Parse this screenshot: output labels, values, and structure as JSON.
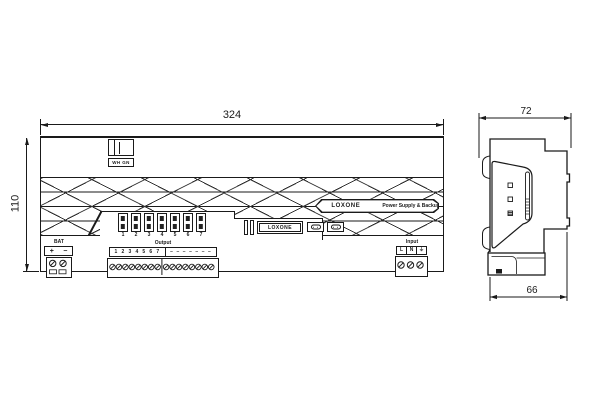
{
  "ink_color": "#1a1a1a",
  "paper_color": "#ffffff",
  "front_view": {
    "width_dim": "324",
    "height_dim": "110",
    "link_label": "WH GN",
    "fuse_numbers": [
      "1",
      "2",
      "3",
      "4",
      "5",
      "6",
      "7"
    ],
    "badge": {
      "brand": "LOXONE",
      "product": "Power Supply & Backup"
    },
    "display_brand": "LOXONE",
    "bat": {
      "label": "BAT",
      "plus": "+",
      "minus": "−"
    },
    "output": {
      "label": "Output",
      "numbers": "1 2 3 4 5 6 7",
      "spares": "− − − − − − −"
    },
    "input": {
      "label": "Input",
      "live": "L",
      "neutral": "N",
      "earth": "⏚"
    }
  },
  "side_view": {
    "depth_dim": "72",
    "base_depth_dim": "66"
  }
}
